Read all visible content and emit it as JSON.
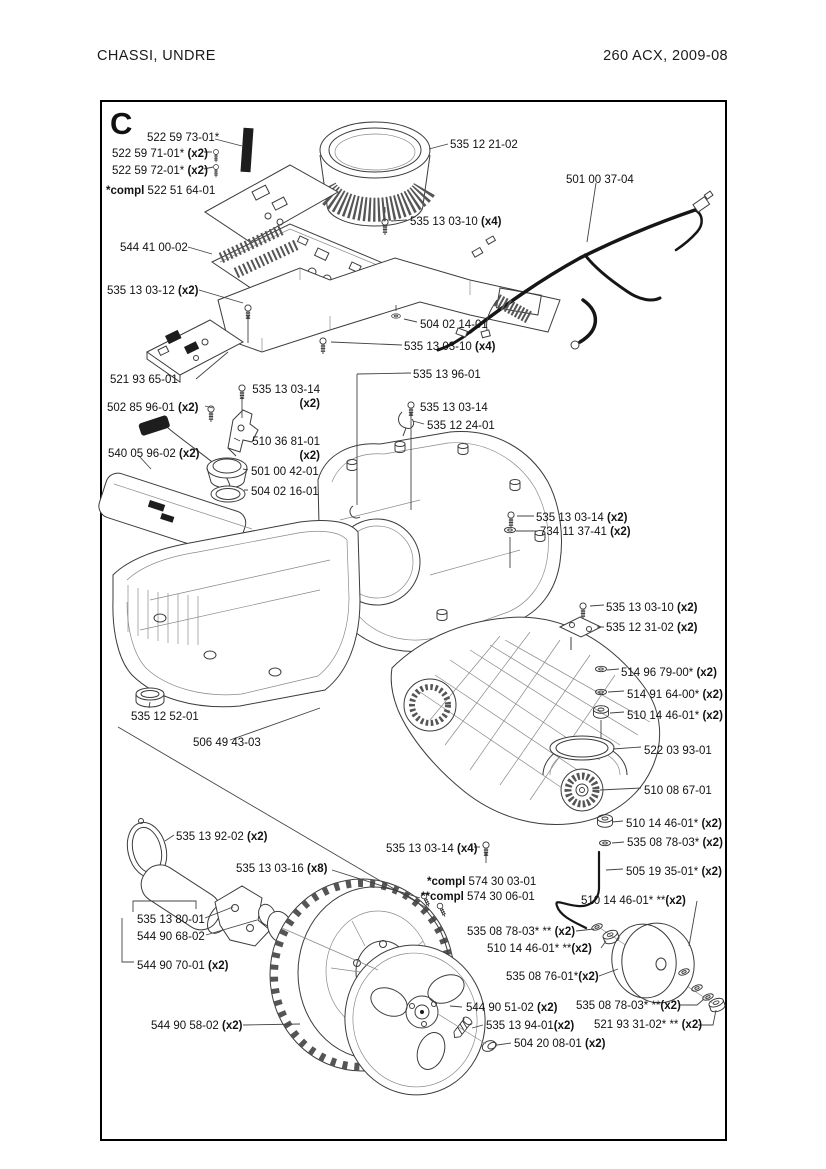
{
  "header": {
    "title_left": "CHASSI,  UNDRE",
    "title_right": "260 ACX, 2009-08"
  },
  "diagram": {
    "section_letter": "C",
    "labels": [
      {
        "num": "522 59 73-01*",
        "x": 147,
        "y": 131
      },
      {
        "num": "522 59 71-01*",
        "q": " (x2)",
        "x": 112,
        "y": 147
      },
      {
        "num": "522 59 72-01*",
        "q": " (x2)",
        "x": 112,
        "y": 164
      },
      {
        "pre": "*compl ",
        "num": "522 51 64-01",
        "x": 106,
        "y": 184
      },
      {
        "num": "544 41 00-02",
        "x": 120,
        "y": 241
      },
      {
        "num": "535 13 03-12",
        "q": " (x2)",
        "x": 107,
        "y": 284
      },
      {
        "num": "535 12 21-02",
        "x": 450,
        "y": 138
      },
      {
        "num": "535 13 03-10",
        "q": " (x4)",
        "x": 410,
        "y": 215
      },
      {
        "num": "501 00 37-04",
        "x": 566,
        "y": 173
      },
      {
        "num": "504 02 14-01",
        "x": 420,
        "y": 318
      },
      {
        "num": "535 13 03-10",
        "q": " (x4)",
        "x": 404,
        "y": 340
      },
      {
        "num": "535 13 96-01",
        "x": 413,
        "y": 368
      },
      {
        "num": "521 93 65-01",
        "x": 110,
        "y": 373
      },
      {
        "num": "535 13 03-14",
        "q2": "(x2)",
        "x": 236,
        "y": 383,
        "w": 84,
        "stack": true
      },
      {
        "num": "502 85 96-01",
        "q": " (x2)",
        "x": 107,
        "y": 401
      },
      {
        "num": "535 13 03-14",
        "x": 420,
        "y": 401
      },
      {
        "num": "535 12 24-01",
        "x": 427,
        "y": 419
      },
      {
        "num": "510 36 81-01",
        "q2": "(x2)",
        "x": 236,
        "y": 435,
        "w": 84,
        "stack": true
      },
      {
        "num": "540 05 96-02",
        "q": " (x2)",
        "x": 108,
        "y": 447
      },
      {
        "num": "501 00 42-01",
        "x": 251,
        "y": 465
      },
      {
        "num": "504 02 16-01",
        "x": 251,
        "y": 485
      },
      {
        "num": "535 13 03-14",
        "q": " (x2)",
        "x": 536,
        "y": 511
      },
      {
        "num": "734 11 37-41",
        "q": " (x2)",
        "x": 540,
        "y": 525
      },
      {
        "num": "535 13 03-10",
        "q": " (x2)",
        "x": 606,
        "y": 601
      },
      {
        "num": "535 12 31-02",
        "q": " (x2)",
        "x": 606,
        "y": 621
      },
      {
        "num": "514 96 79-00*",
        "q": " (x2)",
        "x": 621,
        "y": 666
      },
      {
        "num": "514 91 64-00*",
        "q": " (x2)",
        "x": 627,
        "y": 688
      },
      {
        "num": "510 14 46-01*",
        "q": " (x2)",
        "x": 627,
        "y": 709
      },
      {
        "num": "522 03 93-01",
        "x": 644,
        "y": 744
      },
      {
        "num": "510 08 67-01",
        "x": 644,
        "y": 784
      },
      {
        "num": "510 14 46-01*",
        "q": " (x2)",
        "x": 626,
        "y": 817
      },
      {
        "num": "535 08 78-03*",
        "q": " (x2)",
        "x": 627,
        "y": 836
      },
      {
        "num": "505 19 35-01*",
        "q": " (x2)",
        "x": 626,
        "y": 865
      },
      {
        "num": "535 12 52-01",
        "x": 131,
        "y": 710
      },
      {
        "num": "506 49 43-03",
        "x": 193,
        "y": 736
      },
      {
        "num": "535 13 92-02",
        "q": " (x2)",
        "x": 176,
        "y": 830
      },
      {
        "num": "535 13 03-16",
        "q": " (x8)",
        "x": 236,
        "y": 862
      },
      {
        "num": "535 13 80-01",
        "x": 137,
        "y": 913
      },
      {
        "num": "544 90 68-02",
        "x": 137,
        "y": 930
      },
      {
        "num": "544 90 70-01",
        "q": " (x2)",
        "x": 137,
        "y": 959
      },
      {
        "num": "535 13 03-14",
        "q": " (x4)",
        "x": 386,
        "y": 842
      },
      {
        "pre": "*compl ",
        "num": "574 30 03-01",
        "x": 427,
        "y": 875
      },
      {
        "pre": "**compl ",
        "num": "574 30 06-01",
        "x": 421,
        "y": 890
      },
      {
        "num": "510 14 46-01* **",
        "q": "(x2)",
        "x": 581,
        "y": 894
      },
      {
        "num": "535 08 78-03* **",
        "q": " (x2)",
        "x": 467,
        "y": 925
      },
      {
        "num": "510 14 46-01* **",
        "q": "(x2)",
        "x": 487,
        "y": 942
      },
      {
        "num": "535 08 76-01*",
        "q": "(x2)",
        "x": 506,
        "y": 970
      },
      {
        "num": "544 90 58-02",
        "q": " (x2)",
        "x": 151,
        "y": 1019
      },
      {
        "num": "544 90 51-02",
        "q": " (x2)",
        "x": 466,
        "y": 1001
      },
      {
        "num": "535 13 94-01",
        "q": "(x2)",
        "x": 486,
        "y": 1019
      },
      {
        "num": "504 20 08-01",
        "q": " (x2)",
        "x": 514,
        "y": 1037
      },
      {
        "num": "535 08 78-03* **",
        "q": "(x2)",
        "x": 576,
        "y": 999
      },
      {
        "num": "521 93 31-02* **",
        "q": " (x2)",
        "x": 594,
        "y": 1018
      }
    ]
  }
}
